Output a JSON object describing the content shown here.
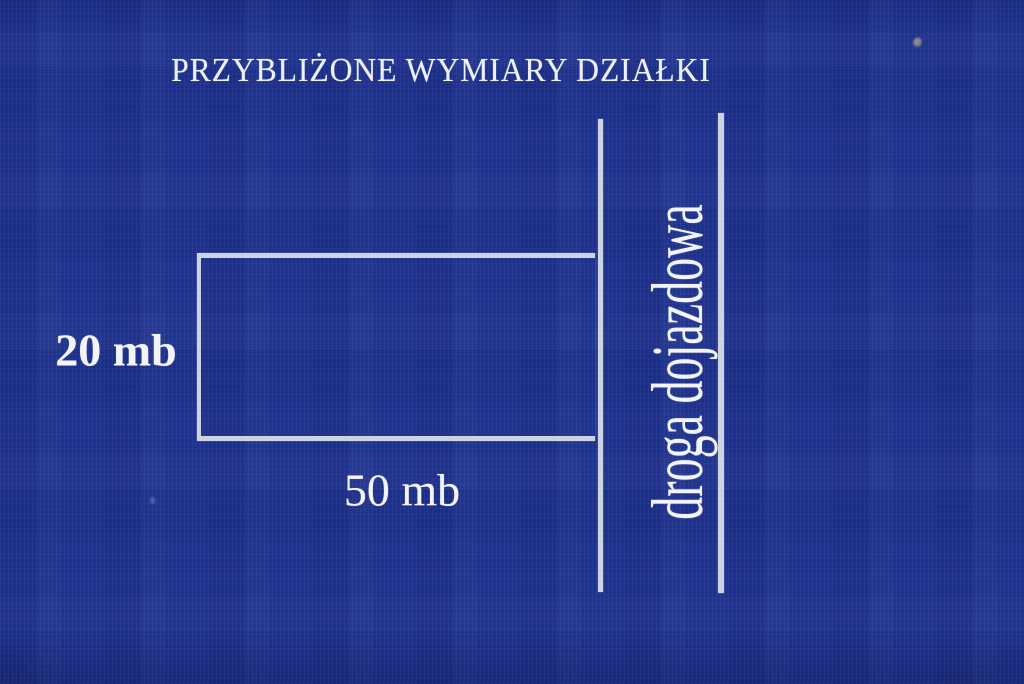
{
  "title": "PRZYBLIŻONE WYMIARY DZIAŁKI",
  "diagram": {
    "plot": {
      "height_label": "20 mb",
      "width_label": "50 mb"
    },
    "road": {
      "label": "droga dojazdowa"
    }
  },
  "colors": {
    "background": "#1f338f",
    "line": "#ccd3e3",
    "text": "#f3f4f8"
  }
}
